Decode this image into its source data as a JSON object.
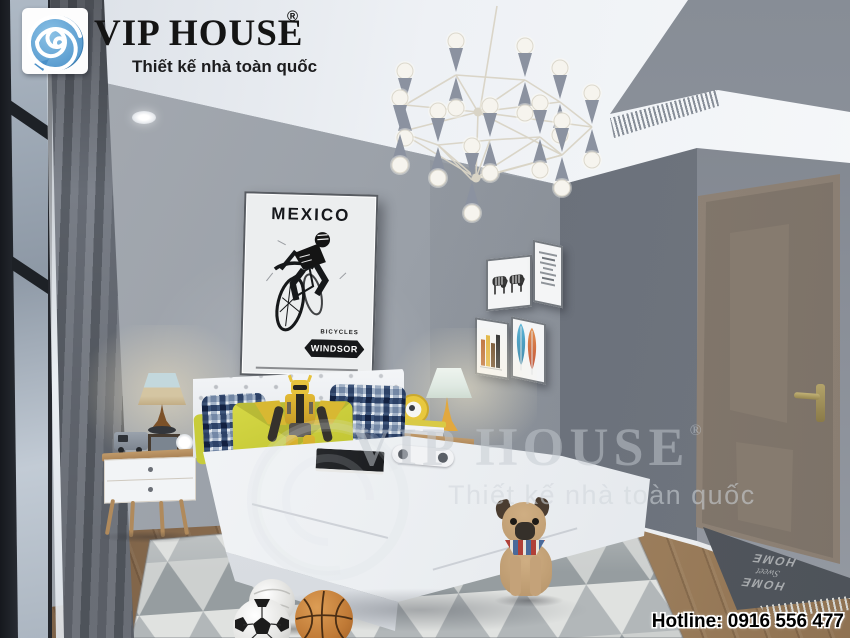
{
  "brand": {
    "name": "VIP HOUSE",
    "registered": "®",
    "tagline": "Thiết kế nhà toàn quốc",
    "blue": "#5b9fd4",
    "text_color": "#141414"
  },
  "watermark": {
    "name": "VIP HOUSE",
    "registered": "®",
    "tagline": "Thiết kế nhà toàn quốc"
  },
  "footer": {
    "hotline": "Hotline: 0916 556 477"
  },
  "poster": {
    "title": "MEXICO",
    "subtitle": "BICYCLES",
    "badge": "WINDSOR"
  },
  "doormat": {
    "line1": "HOME",
    "line2": "Sweet",
    "line3": "HOME"
  },
  "palette": {
    "wall": "#9aa0a8",
    "wall_dark": "#6f7580",
    "door_wall": "#8b9099",
    "ceiling": "#f0f3f7",
    "floor_wood": "#8a6c4e",
    "bed_white": "#f4f5f7",
    "accent_yellow": "#ccd03b",
    "plaid_navy": "#2f4b74",
    "door_wood": "#8b8177",
    "rug_light": "#e0e2e0",
    "rug_dark": "#969da0"
  }
}
